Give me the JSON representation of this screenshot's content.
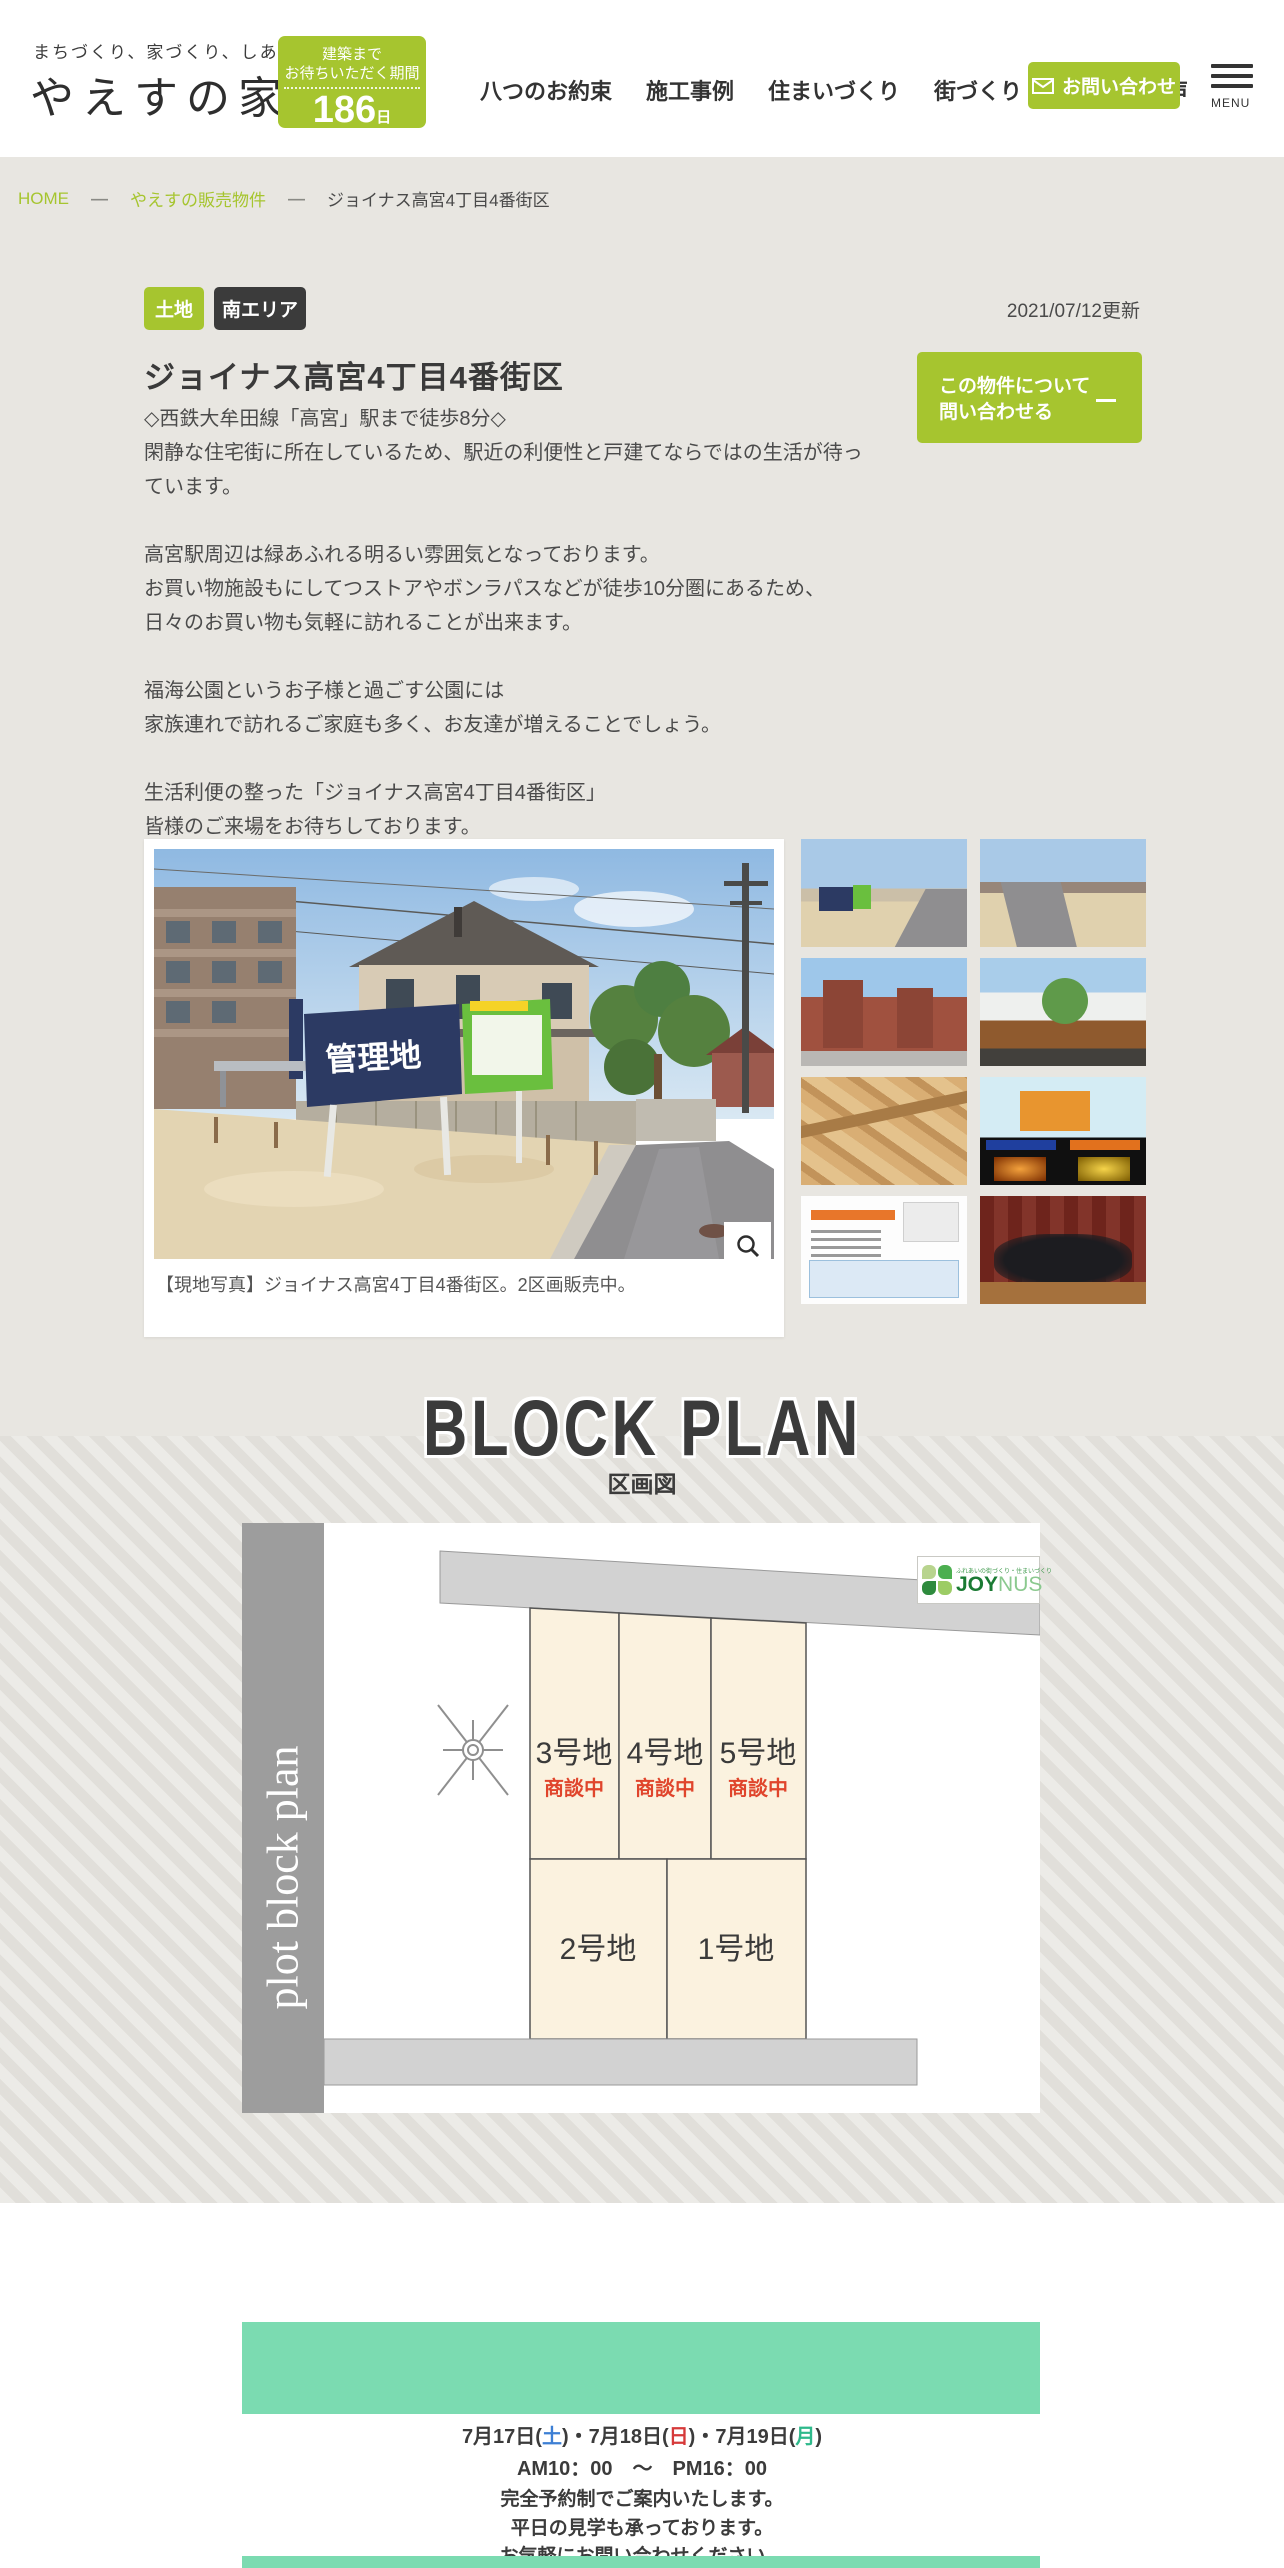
{
  "header": {
    "tagline": "まちづくり、家づくり、しあわせづくり",
    "logo": "やえすの家",
    "badge": {
      "line1": "建築まで",
      "line2": "お待ちいただく期間",
      "days": "186",
      "unit": "日"
    },
    "nav": [
      "八つのお約束",
      "施工事例",
      "住まいづくり",
      "街づくり",
      "お客さまの声"
    ],
    "contact_button": "お問い合わせ",
    "menu_label": "MENU"
  },
  "breadcrumb": {
    "home": "HOME",
    "sep": "—",
    "parent": "やえすの販売物件",
    "current": "ジョイナス高宮4丁目4番街区"
  },
  "property": {
    "tag_type": "土地",
    "tag_area": "南エリア",
    "updated": "2021/07/12更新",
    "title": "ジョイナス高宮4丁目4番街区",
    "cta_line1": "この物件について",
    "cta_line2": "問い合わせる",
    "description": "◇西鉄大牟田線「高宮」駅まで徒歩8分◇\n閑静な住宅街に所在しているため、駅近の利便性と戸建てならではの生活が待っています。\n\n高宮駅周辺は緑あふれる明るい雰囲気となっております。\nお買い物施設もにしてつストアやボンラパスなどが徒歩10分圏にあるため、\n日々のお買い物も気軽に訪れることが出来ます。\n\n福海公園というお子様と過ごす公園には\n家族連れで訪れるご家庭も多く、お友達が増えることでしょう。\n\n生活利便の整った「ジョイナス高宮4丁目4番街区」\n皆様のご来場をお待ちしております。",
    "photo_sign_text": "管理地",
    "photo_caption": "【現地写真】ジョイナス高宮4丁目4番街区。2区画販売中。"
  },
  "block_plan": {
    "heading": "BLOCK PLAN",
    "subheading": "区画図",
    "watermark": "plot block plan",
    "logo": {
      "tagline": "ふれあいの街づくり・住まいづくり",
      "name_bold": "JOY",
      "name_light": "NUS"
    },
    "lots": [
      {
        "name": "3号地",
        "status": "商談中"
      },
      {
        "name": "4号地",
        "status": "商談中"
      },
      {
        "name": "5号地",
        "status": "商談中"
      },
      {
        "name": "2号地",
        "status": ""
      },
      {
        "name": "1号地",
        "status": ""
      }
    ]
  },
  "event": {
    "parts": [
      "7月17日(",
      "土",
      ")・7月18日(",
      "日",
      ")・7月19日(",
      "月",
      ")"
    ],
    "time": "AM10：00　〜　PM16：00",
    "note1": "完全予約制でご案内いたします。",
    "note2": "平日の見学も承っております。",
    "note3": "お気軽にお問い合わせください。"
  },
  "colors": {
    "accent_green": "#a6c52f",
    "mint": "#7bdbb1",
    "status_red": "#e0452c"
  }
}
